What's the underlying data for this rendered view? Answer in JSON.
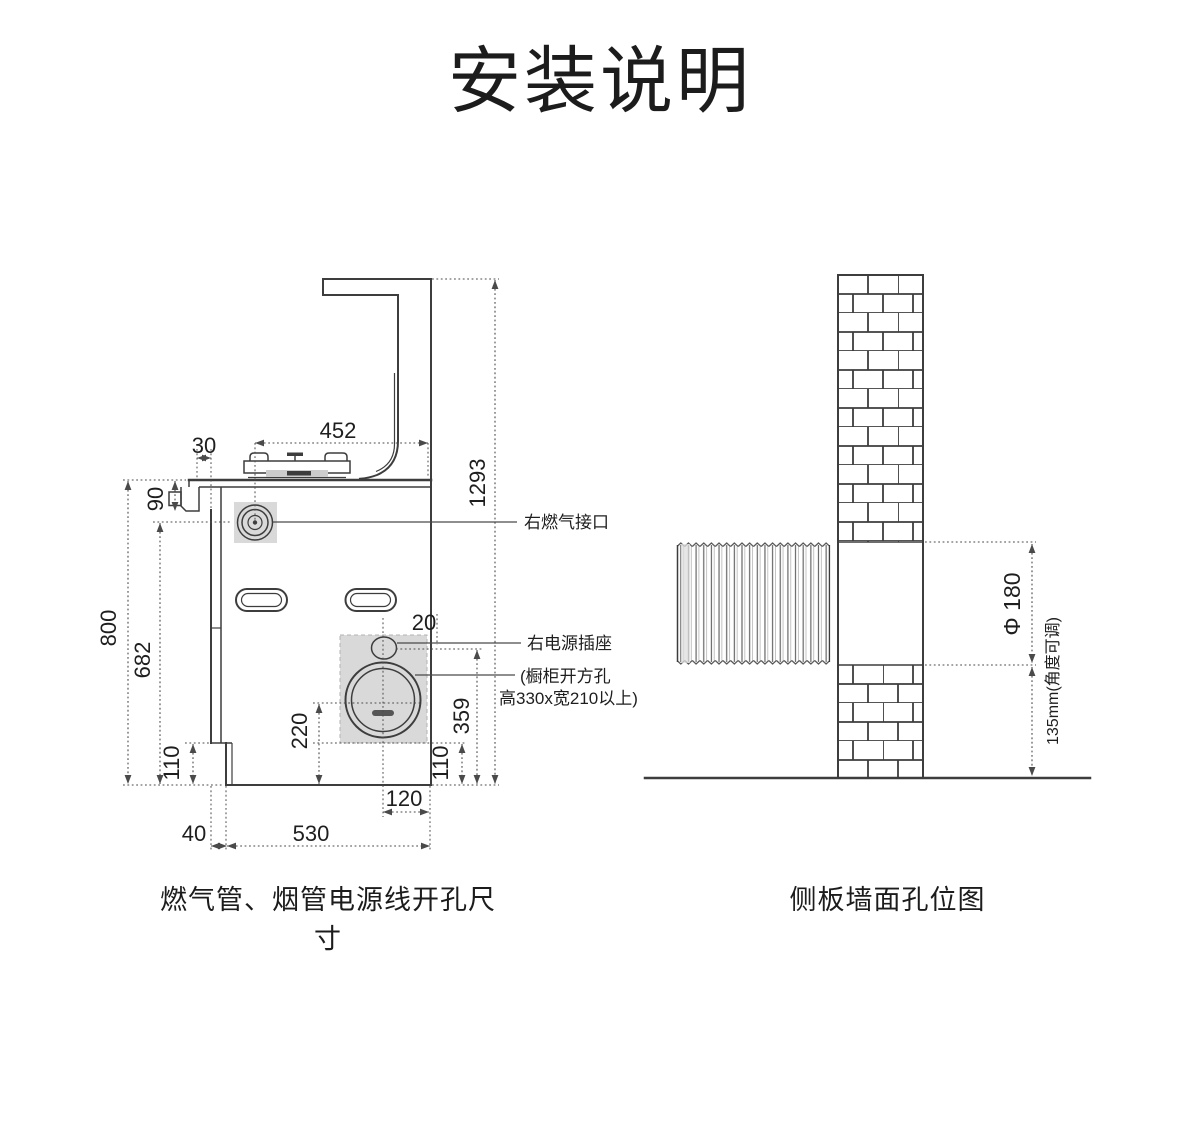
{
  "title": "安装说明",
  "left_diagram": {
    "caption": "燃气管、烟管电源线开孔尺寸",
    "annotations": {
      "gas_port": "右燃气接口",
      "power_socket": "右电源插座",
      "cabinet_cutout_line1": "(橱柜开方孔",
      "cabinet_cutout_line2": "高330x宽210以上)"
    },
    "dimensions": {
      "top_width": "452",
      "left_offset": "30",
      "valve_height": "90",
      "total_height": "1293",
      "body_height": "800",
      "gas_port_height": "682",
      "bottom_left_height": "110",
      "hole_center_height": "220",
      "bottom_right_height": "110",
      "socket_height": "359",
      "edge_gap": "20",
      "hole_offset": "120",
      "step_depth": "40",
      "body_depth": "530"
    }
  },
  "right_diagram": {
    "caption": "侧板墙面孔位图",
    "dimensions": {
      "hole_diameter": "Φ 180",
      "hole_height": "135mm(角度可调)"
    }
  },
  "colors": {
    "line": "#3d3d3d",
    "dim_line": "#4a4a4a",
    "shade": "#d9d9d9",
    "text": "#1e1e1e",
    "background": "#ffffff"
  }
}
